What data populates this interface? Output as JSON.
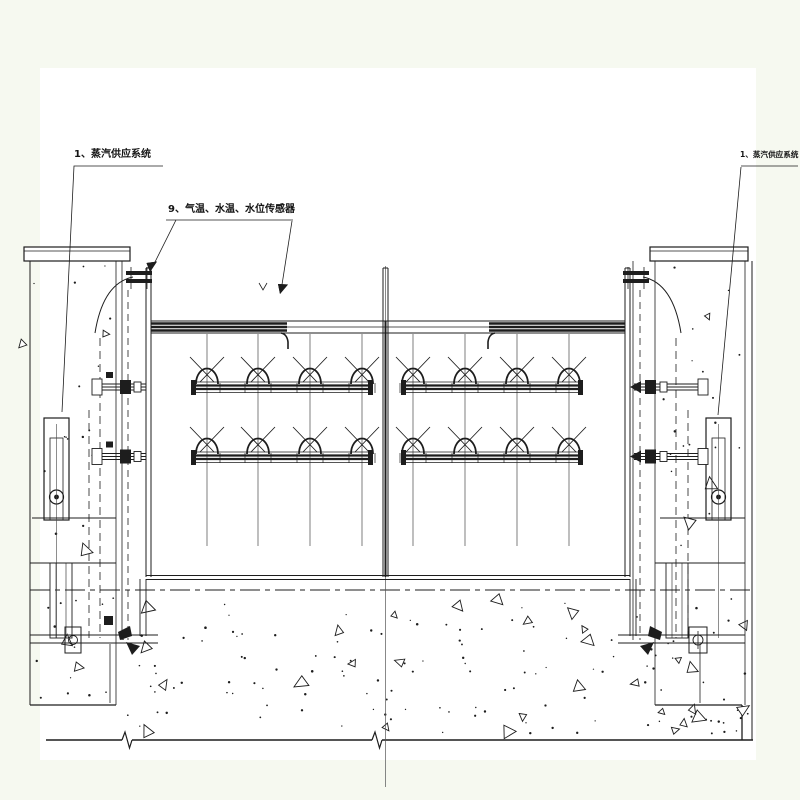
{
  "drawing": {
    "background_color": "#f6f9f0",
    "paper_color": "#ffffff",
    "ink_color": "#1d1d1d",
    "labels": {
      "steam_supply_left": "1、蒸汽供应系统",
      "sensors": "9、气温、水温、水位传感器",
      "steam_supply_right": "1、蒸汽供应系统"
    }
  }
}
